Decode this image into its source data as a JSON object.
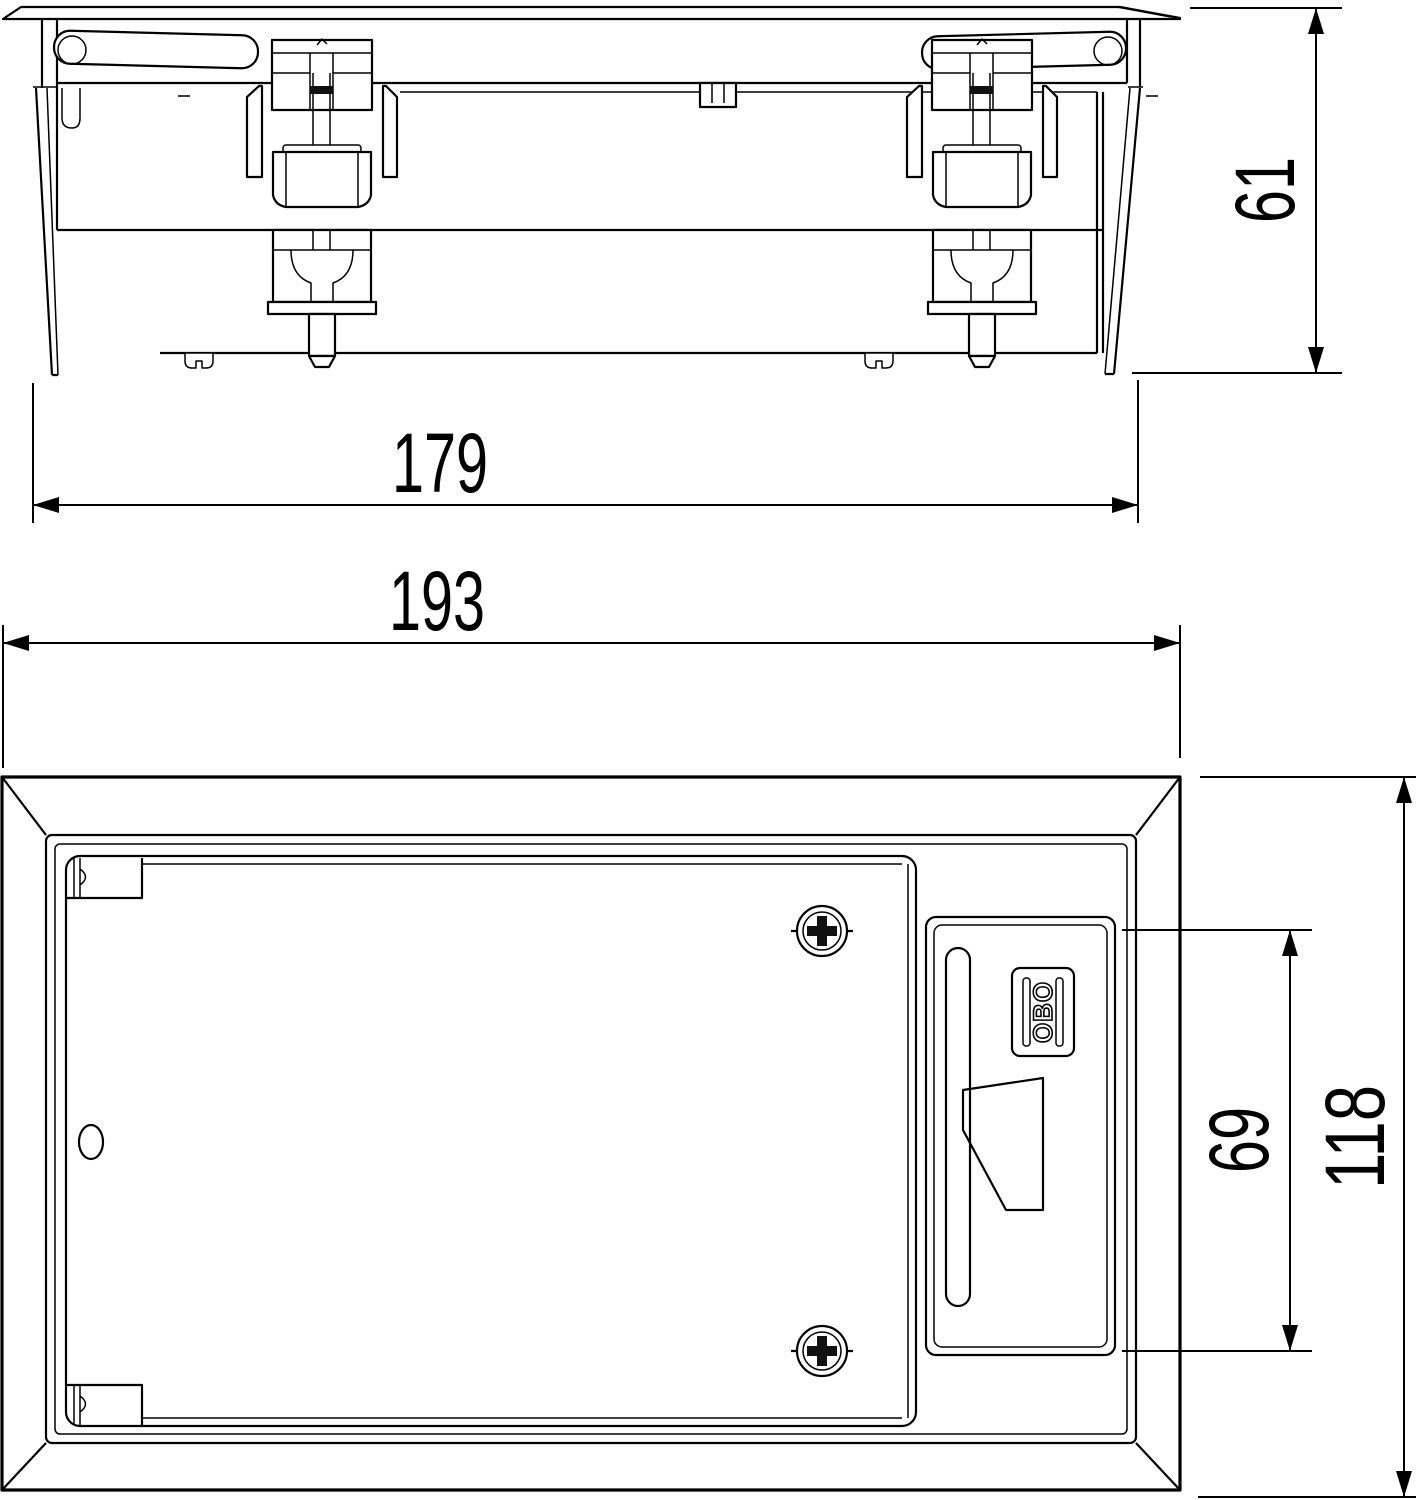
{
  "drawing": {
    "background_color": "#ffffff",
    "line_color": "#000000"
  },
  "dimensions": {
    "elevation_body_width": "179",
    "elevation_overall_width": "193",
    "elevation_height": "61",
    "plan_latch_spacing": "69",
    "plan_overall_depth": "118"
  },
  "branding": {
    "logo_text": "OBO"
  }
}
